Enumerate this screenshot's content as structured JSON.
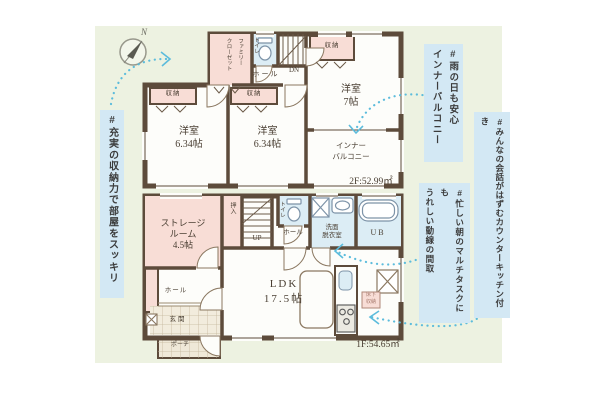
{
  "colors": {
    "background": "#ffffff",
    "plan_background": "#edf2e1",
    "wall": "#5d4b3b",
    "closet_fill": "#f8ddd6",
    "wet_area_fill": "#dcedf5",
    "hashtag_bg": "#d3e8f4",
    "arrow": "#5cbcdc",
    "label_ink": "#4a3f33"
  },
  "compass": {
    "north": "N"
  },
  "hashtags": {
    "storage": "#充実の収納力で部屋をスッキリ",
    "inner_balcony": "#雨の日も安心\nインナーバルコニー",
    "counter_kitchen": "#みんなの会話がはずむカウンターキッチン付き",
    "flow_line": "#忙しい朝のマルチタスクにも\nうれしい動線の間取"
  },
  "floor2": {
    "area": "2F:52.99㎡",
    "family_closet": "ファミリー\nクローゼット",
    "toilet": "トイレ",
    "hall": "ホール",
    "down": "DN",
    "closet": "収納",
    "room_a": "洋室\n6.34帖",
    "room_b": "洋室\n6.34帖",
    "room_c": "洋室\n7帖",
    "inner_balcony": "インナー\nバルコニー"
  },
  "floor1": {
    "area": "1F:54.65㎡",
    "storage_room": "ストレージ\nルーム\n4.5帖",
    "oshiire": "押入",
    "up": "UP",
    "toilet": "トイレ",
    "hall": "ホール",
    "washroom": "洗面\n脱衣室",
    "bath": "UB",
    "ldk": "LDK\n17.5帖",
    "underfloor_storage": "床下\n収納",
    "entrance_hall": "ホール",
    "entrance": "玄関",
    "porch": "ポーチ"
  }
}
